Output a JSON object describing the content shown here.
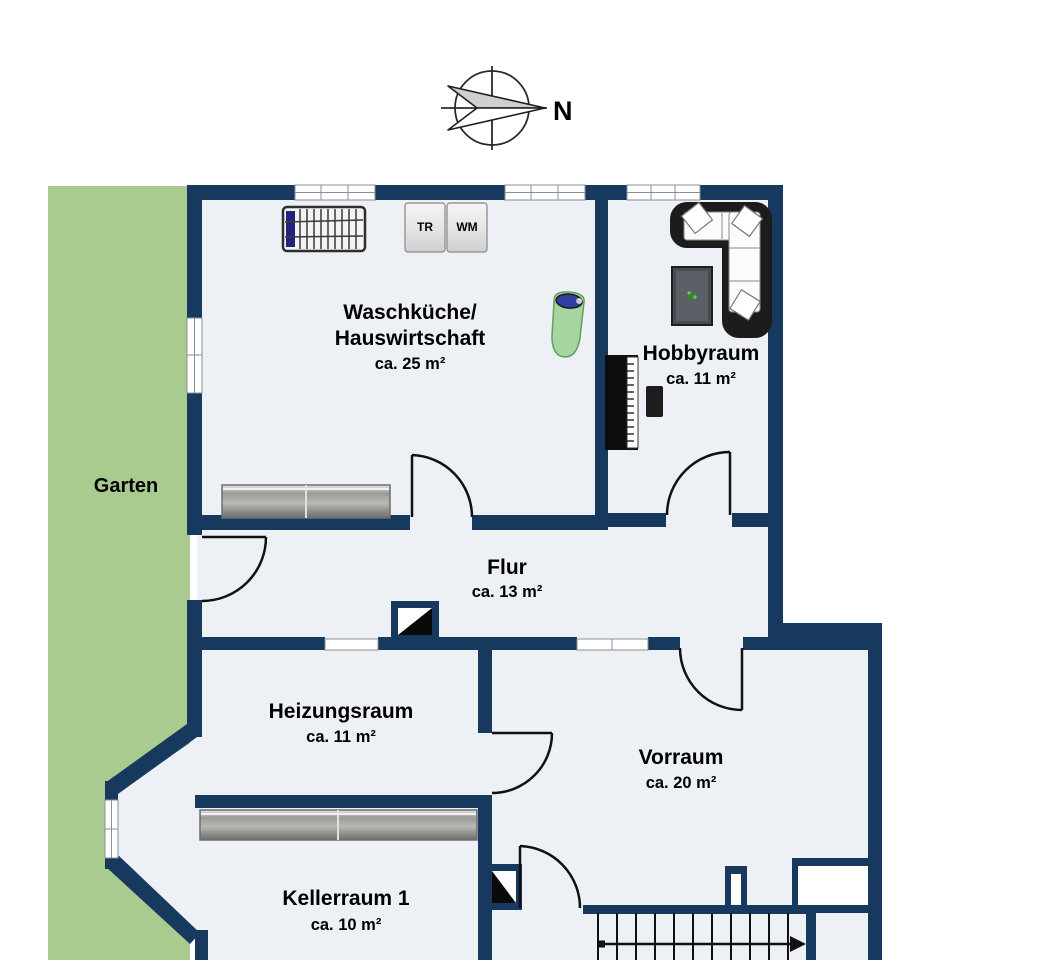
{
  "compass": {
    "north_label": "N"
  },
  "garden": {
    "label": "Garten"
  },
  "rooms": {
    "waschkueche": {
      "name_line1": "Waschküche/",
      "name_line2": "Hauswirtschaft",
      "area": "ca. 25 m²"
    },
    "hobbyraum": {
      "name": "Hobbyraum",
      "area": "ca. 11 m²"
    },
    "flur": {
      "name": "Flur",
      "area": "ca. 13 m²"
    },
    "heizungsraum": {
      "name": "Heizungsraum",
      "area": "ca. 11 m²"
    },
    "vorraum": {
      "name": "Vorraum",
      "area": "ca. 20 m²"
    },
    "kellerraum1": {
      "name": "Kellerraum 1",
      "area": "ca. 10 m²"
    }
  },
  "appliances": {
    "dryer_label": "TR",
    "washer_label": "WM"
  },
  "furniture": [
    "drying-rack",
    "dryer",
    "washing-machine",
    "ironing-board",
    "sideboard",
    "corner-sofa",
    "coffee-table",
    "piano",
    "piano-bench"
  ],
  "colors": {
    "wall": "#17395E",
    "floor": "#EDF0F5",
    "garden": "#A9CB8F",
    "window": "#FFFFFF",
    "door_line": "#111111"
  }
}
